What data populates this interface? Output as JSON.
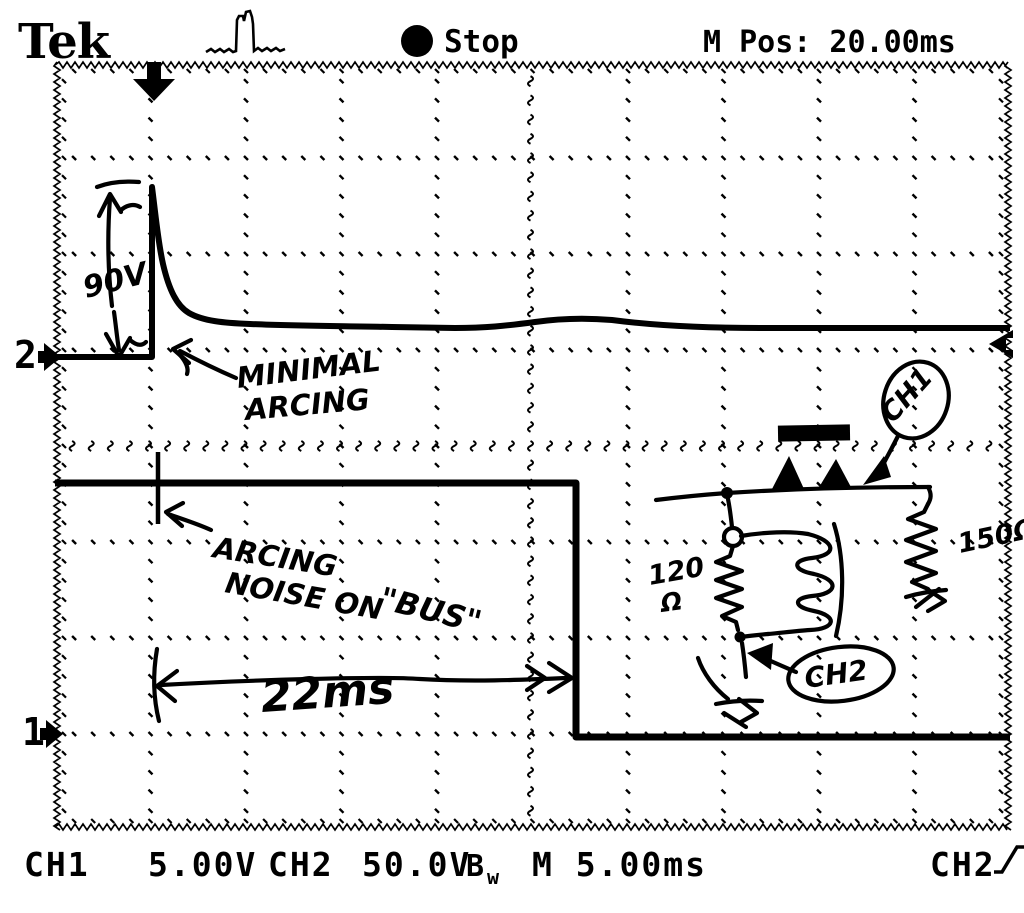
{
  "header": {
    "logo": "Tek",
    "acquisition_status": "Stop",
    "horizontal_position": "M Pos: 20.00ms"
  },
  "icons": {
    "stop": "filled-circle",
    "trigger_type": "pulse-waveform",
    "trigger_slope": "rising-edge"
  },
  "channel_markers": {
    "ch2": "2",
    "ch1": "1"
  },
  "readouts": {
    "ch1_label": "CH1",
    "ch1_scale": "5.00V",
    "ch2_label": "CH2",
    "ch2_scale": "50.0V",
    "bw_limit": "B",
    "bw_limit_sub": "w",
    "timebase": "M 5.00ms",
    "trigger_source": "CH2"
  },
  "annotations": {
    "voltage_measure": "90V",
    "minimal_arcing_line1": "MINIMAL",
    "minimal_arcing_line2": "ARCING",
    "noise_line1": "ARCING",
    "noise_line2": "NOISE ON",
    "noise_line3": "\"BUS\"",
    "time_measure": "22ms",
    "circuit": {
      "probe1": "CH1",
      "probe2": "CH2",
      "resistor_left_value": "120",
      "resistor_left_unit": "Ω",
      "resistor_right": "150Ω"
    }
  }
}
